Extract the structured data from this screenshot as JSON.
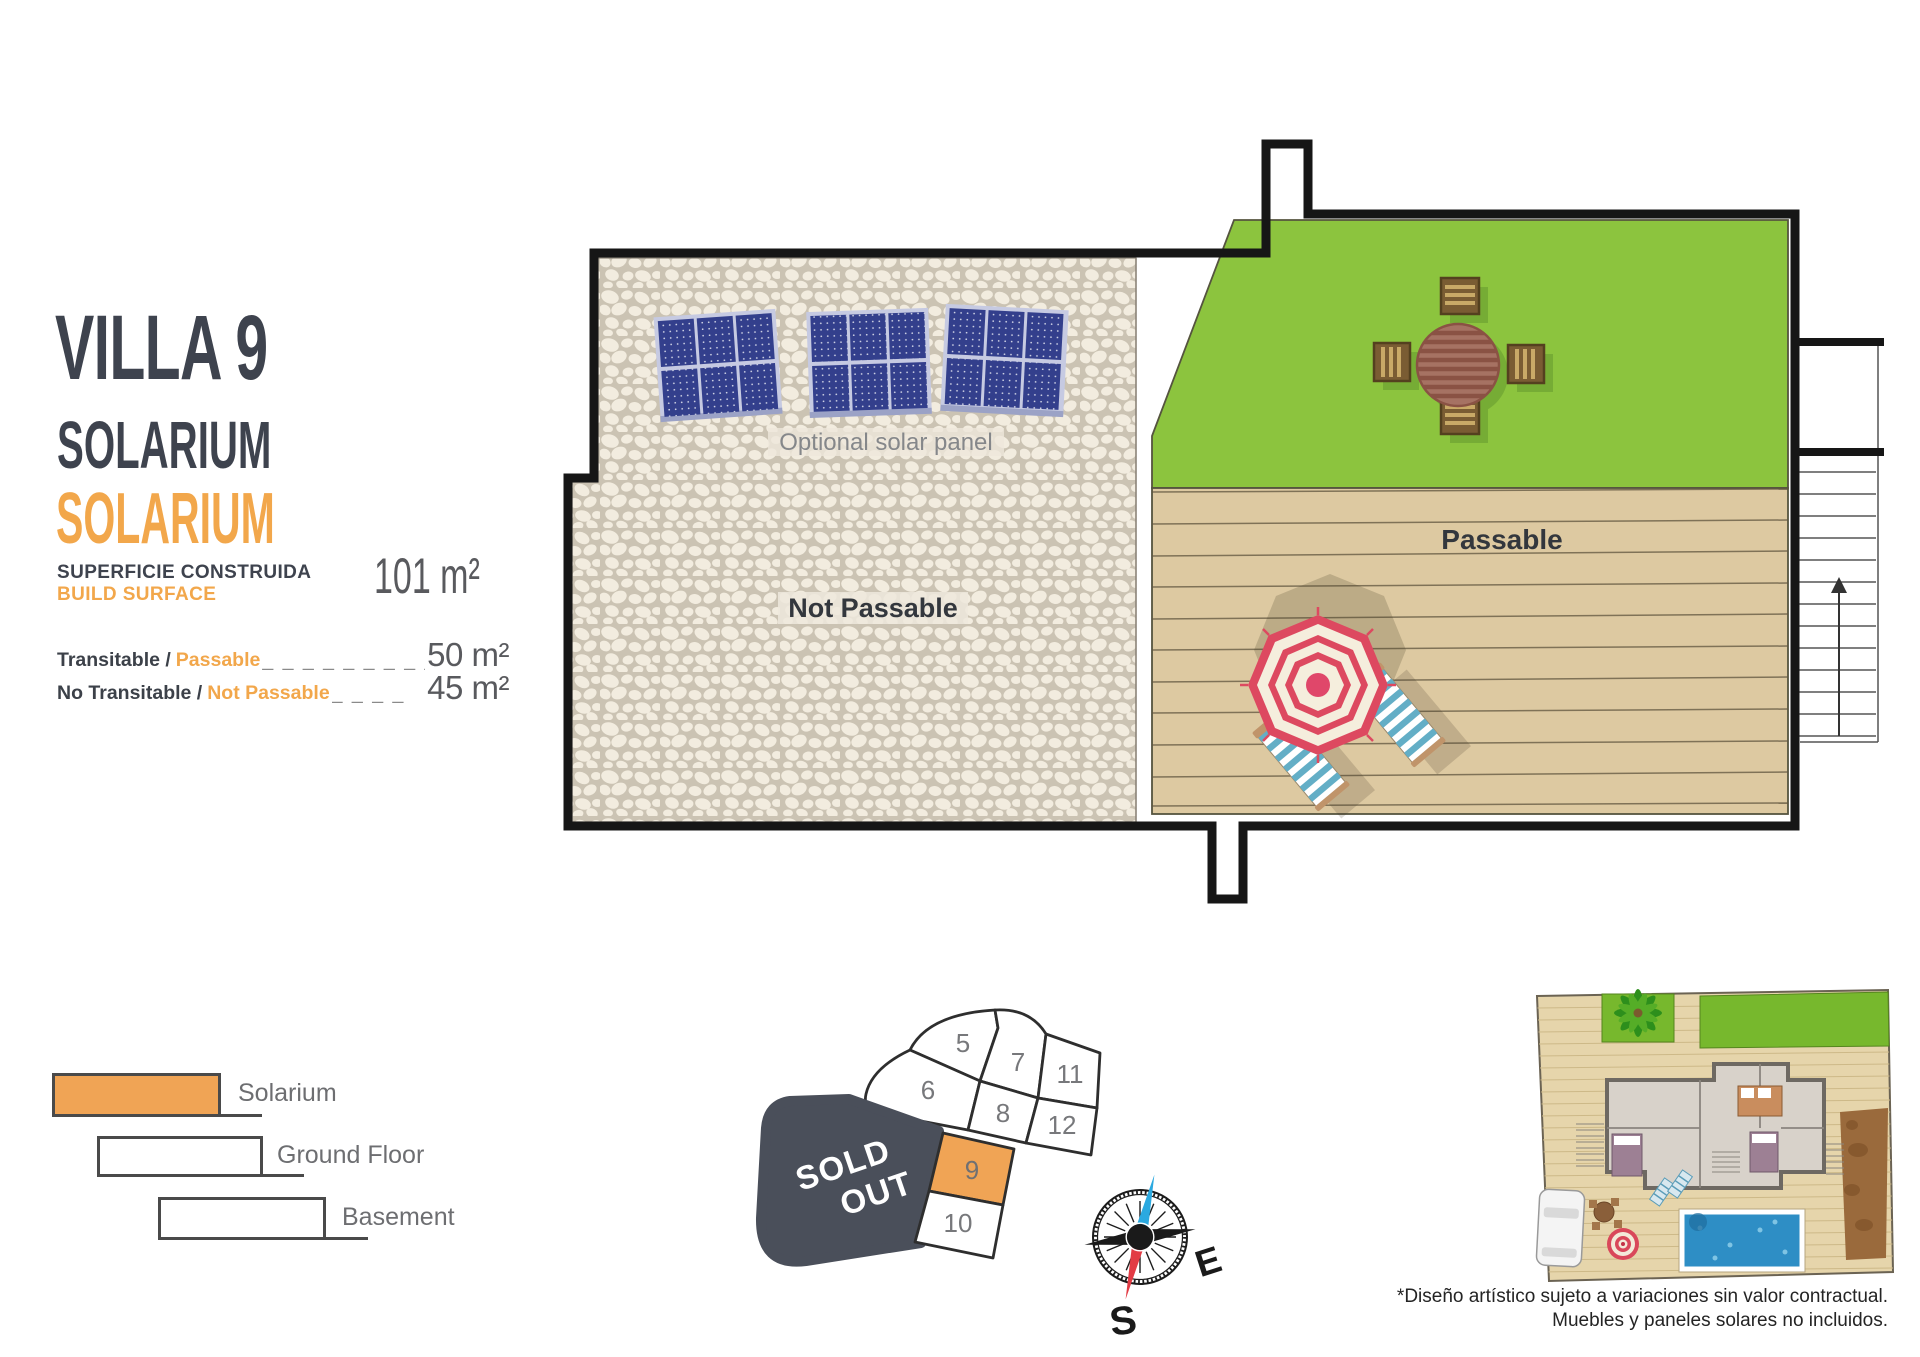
{
  "title": {
    "villa": "VILLA 9",
    "floor_dark": "SOLARIUM",
    "floor_orange": "SOLARIUM"
  },
  "surface": {
    "label_es": "SUPERFICIE CONSTRUIDA",
    "label_en": "BUILD SURFACE",
    "total": "101 m²",
    "rows": [
      {
        "label": "Transitable /",
        "highlight": "Passable",
        "dashes": "_ _ _ _ _ _ _ _ _",
        "value": "50 m²"
      },
      {
        "label": "No Transitable /",
        "highlight": "Not Passable",
        "dashes": "_ _ _ _",
        "value": "45 m²"
      }
    ]
  },
  "legend": {
    "items": [
      {
        "label": "Solarium",
        "color": "#F0A455"
      },
      {
        "label": "Ground Floor",
        "color": "#FFFFFF"
      },
      {
        "label": "Basement",
        "color": "#FFFFFF"
      }
    ]
  },
  "plan": {
    "optional_solar": "Optional solar panel",
    "not_passable": "Not Passable",
    "passable": "Passable"
  },
  "plot_map": {
    "sold_out": {
      "line1": "SOLD",
      "line2": "OUT"
    },
    "highlighted_plot": "9",
    "plots": [
      {
        "number": "5"
      },
      {
        "number": "6"
      },
      {
        "number": "7"
      },
      {
        "number": "8"
      },
      {
        "number": "11"
      },
      {
        "number": "12"
      },
      {
        "number": "9"
      },
      {
        "number": "10"
      }
    ]
  },
  "compass": {
    "east": "E",
    "south": "S"
  },
  "disclaimer": {
    "line1": "*Diseño artístico sujeto a variaciones sin valor contractual.",
    "line2": "Muebles y paneles solares no incluidos."
  },
  "colors": {
    "accent_orange": "#F2A74B",
    "title_dark": "#3E434E",
    "grass_green": "#8CC43E",
    "deck_tan": "#DDC9A1",
    "wall_black": "#161616",
    "sold_out_bg": "#4A4F5A",
    "plot_highlight": "#F0A455",
    "umbrella_red": "#DD4960",
    "solar_panel_blue": "#333F8C"
  }
}
